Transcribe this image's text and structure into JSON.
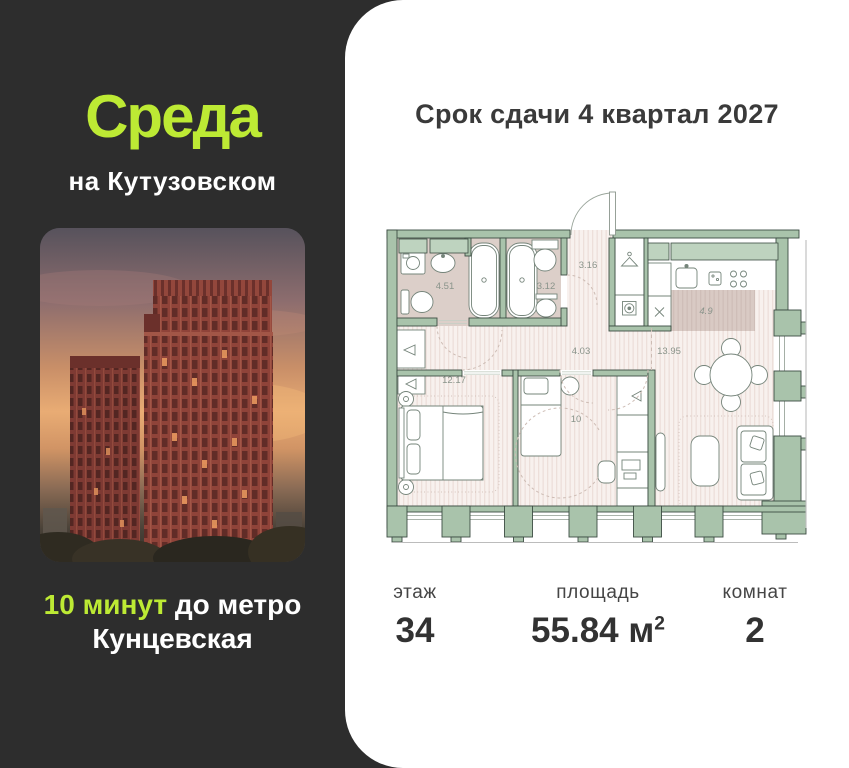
{
  "left_panel": {
    "logo_title": "Среда",
    "logo_subtitle": "на Кутузовском",
    "metro_highlight": "10 минут",
    "metro_rest": "до метро",
    "metro_line2": "Кунцевская"
  },
  "card": {
    "deadline": "Срок сдачи 4 квартал 2027",
    "stats": [
      {
        "label": "этаж",
        "value": "34",
        "sup": ""
      },
      {
        "label": "площадь",
        "value": "55.84 м",
        "sup": "2"
      },
      {
        "label": "комнат",
        "value": "2",
        "sup": ""
      }
    ]
  },
  "floor_plan": {
    "rooms": [
      {
        "name": "bathroom",
        "area": "4.51"
      },
      {
        "name": "bathroom-2",
        "area": "3.12"
      },
      {
        "name": "entry-hall",
        "area": "3.16"
      },
      {
        "name": "corridor",
        "area": "4.03"
      },
      {
        "name": "bedroom",
        "area": "12.17"
      },
      {
        "name": "bedroom-2",
        "area": "10"
      },
      {
        "name": "living-kitchen",
        "area": "13.95"
      },
      {
        "name": "kitchen-zone",
        "area": "4.9"
      }
    ]
  },
  "colors": {
    "accent_green": "#bdea34",
    "panel_bg": "#2d2d2d",
    "wall_green": "#a9c3ab",
    "floor_stripe": "#f8f1ee",
    "bath_floor": "#dccfc9"
  }
}
